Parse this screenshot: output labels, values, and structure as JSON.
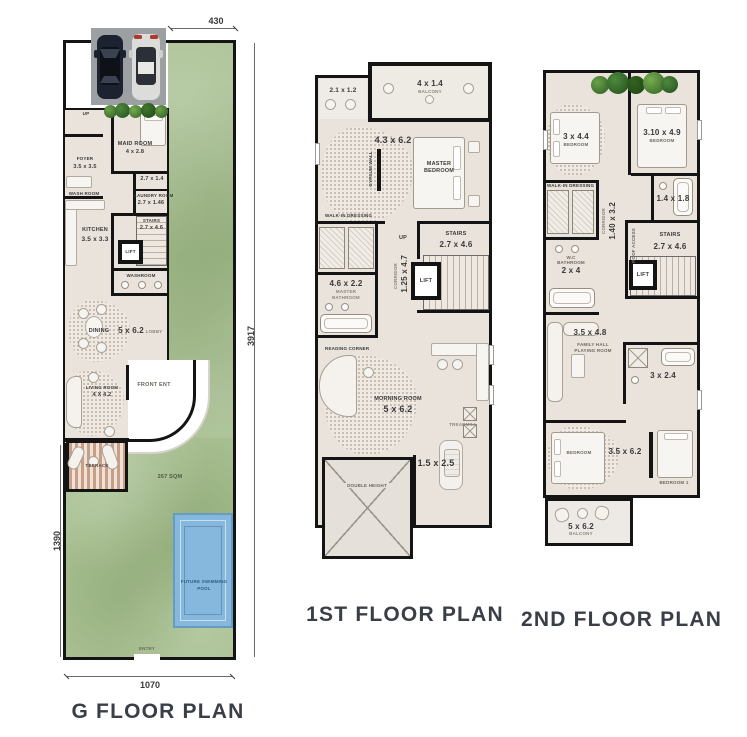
{
  "titles": {
    "g": "G FLOOR PLAN",
    "f1": "1ST FLOOR PLAN",
    "f2": "2ND FLOOR PLAN"
  },
  "g": {
    "dim_top": "430",
    "dim_right": "3917",
    "dim_left": "1390",
    "dim_bottom": "1070",
    "up": "UP",
    "maid_name": "MAID ROOM",
    "maid_size": "4 x 2.8",
    "foyer_name": "FOYER",
    "foyer_size": "3.5 x 3.5",
    "washroom_front": "WASH ROOM",
    "bath_size": "2.7 x 1.4",
    "laundry_name": "LAUNDRY ROOM",
    "laundry_size": "2.7 x 1.46",
    "kitchen_name": "KITCHEN",
    "kitchen_size": "3.5 x 3.3",
    "stairs_name": "STAIRS",
    "stairs_size": "2.7 x 4.6",
    "lift": "LIFT",
    "washroom": "WASHROOM",
    "dining_name": "DINING",
    "dining_size": "5 x 6.2",
    "lobby": "LOBBY",
    "living_name": "LIVING ROOM",
    "living_size": "4 X 4.2",
    "front_ent": "FRONT ENT",
    "terrace": "TERRACE",
    "lawn_area": "267 SQM",
    "pool_line1": "FUTURE SWIMMING",
    "pool_line2": "POOL",
    "entry": "ENTRY"
  },
  "f1": {
    "balcony_small_size": "2.1 x 1.2",
    "balcony_top_size": "4 x 1.4",
    "balcony_top_name": "BALCONY",
    "master_size": "4.3 x 6.2",
    "master_name1": "MASTER",
    "master_name2": "BEDROOM",
    "gypsum": "GYPSUM WALL",
    "dressing": "WALK-IN DRESSING",
    "up": "UP",
    "stairs_name": "STAIRS",
    "stairs_size": "2.7 x 4.6",
    "corridor_name": "CORRIDOR",
    "corridor_size": "1.25 x 4.7",
    "lift": "LIFT",
    "mbath_size": "4.6 x 2.2",
    "mbath_name1": "MASTER",
    "mbath_name2": "BATHROOM",
    "reading": "READING CORNER",
    "morning_name": "MORNING ROOM",
    "morning_size": "5 x 6.2",
    "treadmill": "TREADMILL",
    "balcony_br_size": "1.5 x 2.5",
    "double_height": "DOUBLE HEIGHT"
  },
  "f2": {
    "bed1_size": "3 x 4.4",
    "bed1_name": "BEDROOM",
    "bed2_size": "3.10 x 4.9",
    "bed2_name": "BEDROOM",
    "bath1_size": "1.4 x 1.8",
    "dressing": "WALK-IN DRESSING",
    "wc_name": "W.C",
    "wc_sub": "BATHROOM",
    "wc_size": "2 x 4",
    "corridor_name": "CORRIDOR",
    "corridor_size": "1.40 x 3.2",
    "stairs_name": "STAIRS",
    "stairs_size": "2.7 x 4.6",
    "roof_access": "ROOF ACCESS",
    "lift": "LIFT",
    "family_size": "3.5 x 4.8",
    "family_name": "FAMILY HALL",
    "family_sub": "PLAYING ROOM",
    "bath2_size": "3 x 2.4",
    "bed3_name": "BEDROOM",
    "bed3_size": "3.5 x 6.2",
    "bed4_name": "BEDROOM 1",
    "balcony_size": "5 x 6.2",
    "balcony_name": "BALCONY"
  }
}
